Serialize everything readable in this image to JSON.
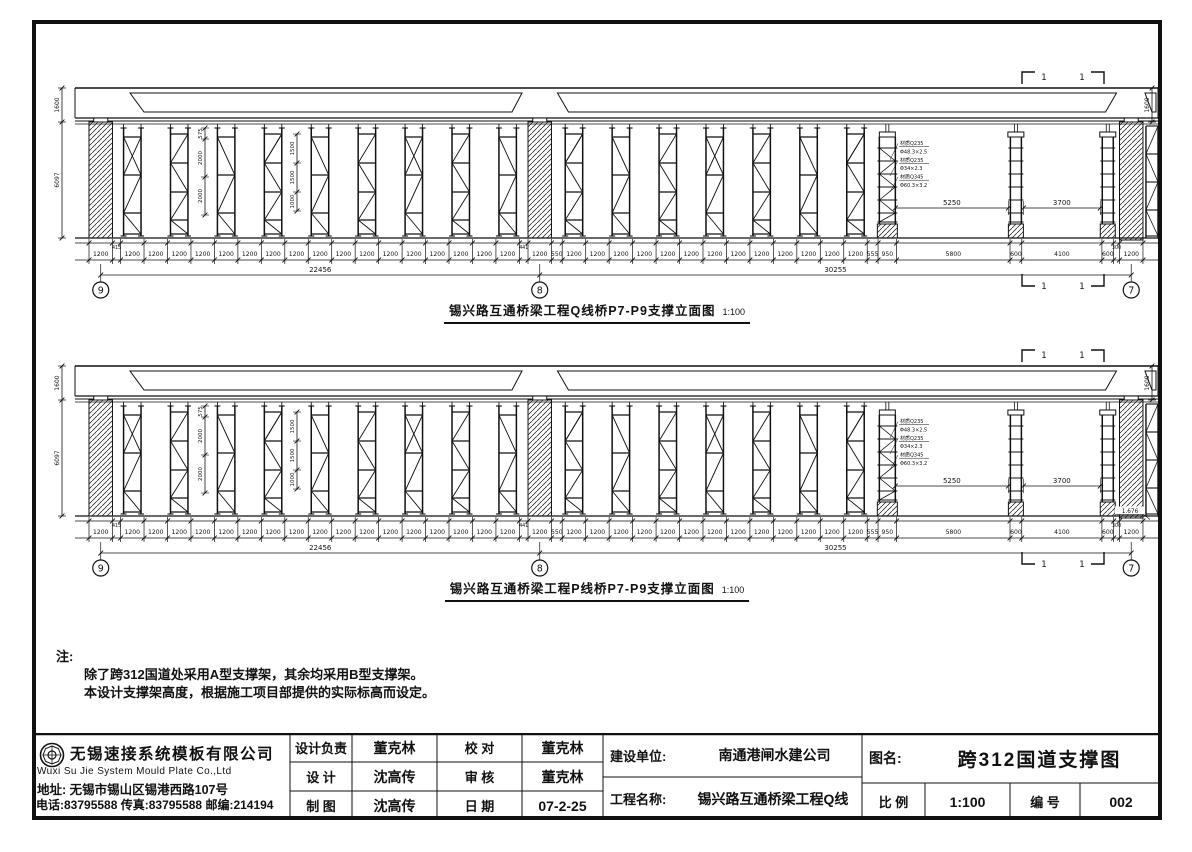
{
  "sheet": {
    "ink": "#111111",
    "bg": "#ffffff"
  },
  "drawings": [
    {
      "caption": "锡兴路互通桥梁工程Q线桥P7-P9支撑立面图",
      "caption_scale": "1:100",
      "grid_bubbles": [
        "9",
        "8",
        "7"
      ],
      "left_dims": [
        "1600",
        "6097"
      ],
      "right_dim": "1600",
      "inner_dims_a": [
        "575",
        "2000",
        "2000"
      ],
      "inner_dims_b": [
        "1500",
        "1500",
        "1000"
      ],
      "span_dims": [
        "5250",
        "3700"
      ],
      "section_label": "1",
      "pipe_specs": [
        "材质Q235",
        "Φ48.3×2.5",
        "材质Q235",
        "Φ34×2.3",
        "材质Q345",
        "Φ60.3×3.2"
      ],
      "segments_mm": [
        1200,
        415,
        1200,
        1200,
        1200,
        1200,
        1200,
        1200,
        1200,
        1200,
        1200,
        1200,
        1200,
        1200,
        1200,
        1200,
        1200,
        1200,
        1200,
        441,
        1200,
        550,
        1200,
        1200,
        1200,
        1200,
        1200,
        1200,
        1200,
        1200,
        1200,
        1200,
        1200,
        1200,
        1200,
        555,
        950,
        5800,
        600,
        4100,
        600,
        300,
        1200
      ],
      "totals": [
        "22456",
        "30255"
      ],
      "elevation_label": null
    },
    {
      "caption": "锡兴路互通桥梁工程P线桥P7-P9支撑立面图",
      "caption_scale": "1:100",
      "grid_bubbles": [
        "9",
        "8",
        "7"
      ],
      "left_dims": [
        "1600",
        "6097"
      ],
      "right_dim": "1600",
      "inner_dims_a": [
        "575",
        "2000",
        "2000"
      ],
      "inner_dims_b": [
        "1500",
        "1500",
        "1000"
      ],
      "span_dims": [
        "5250",
        "3700"
      ],
      "section_label": "1",
      "pipe_specs": [
        "材质Q235",
        "Φ48.3×2.5",
        "材质Q235",
        "Φ34×2.3",
        "材质Q345",
        "Φ60.3×3.2"
      ],
      "segments_mm": [
        1200,
        415,
        1200,
        1200,
        1200,
        1200,
        1200,
        1200,
        1200,
        1200,
        1200,
        1200,
        1200,
        1200,
        1200,
        1200,
        1200,
        1200,
        1200,
        441,
        1200,
        550,
        1200,
        1200,
        1200,
        1200,
        1200,
        1200,
        1200,
        1200,
        1200,
        1200,
        1200,
        1200,
        1200,
        555,
        950,
        5800,
        600,
        4100,
        600,
        300,
        1200
      ],
      "totals": [
        "22456",
        "30255"
      ],
      "elevation_label": "1.676"
    }
  ],
  "notes": {
    "heading": "注:",
    "lines": [
      "除了跨312国道处采用A型支撑架，其余均采用B型支撑架。",
      "本设计支撑架高度，根据施工项目部提供的实际标高而设定。"
    ]
  },
  "title_block": {
    "company": {
      "name": "无锡速接系统模板有限公司",
      "name_en": "Wuxi Su Jie System Mould Plate Co.,Ltd",
      "address": "地址: 无锡市锡山区锡港西路107号",
      "phone": "电话:83795588 传真:83795588 邮编:214194"
    },
    "cells": {
      "design_lead_label": "设计负责",
      "design_lead": "董克林",
      "check_label": "校 对",
      "check": "董克林",
      "design_label": "设 计",
      "design": "沈高传",
      "review_label": "审 核",
      "review": "董克林",
      "draft_label": "制 图",
      "draft": "沈高传",
      "date_label": "日 期",
      "date": "07-2-25",
      "client_label": "建设单位:",
      "client": "南通港闸水建公司",
      "project_label": "工程名称:",
      "project": "锡兴路互通桥梁工程Q线",
      "sheet_name_label": "图名:",
      "sheet_name": "跨312国道支撑图",
      "scale_label": "比 例",
      "scale": "1:100",
      "number_label": "编 号",
      "number": "002"
    }
  }
}
